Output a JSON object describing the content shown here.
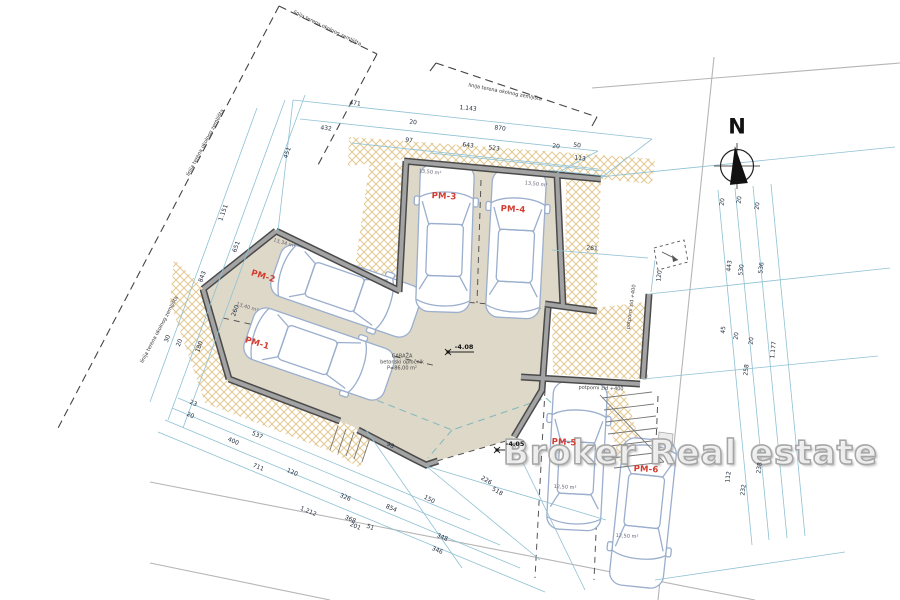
{
  "compass": {
    "label": "N"
  },
  "watermark": {
    "text": "Broker Real estate"
  },
  "colors": {
    "dimension_line": "#8fc1d4",
    "hatch": "#d8b56b",
    "floor": "#ded8c8",
    "wall": "#4a4a4a",
    "parking_label": "#d43c31",
    "watermark_gray": "#a6a6a6"
  },
  "parking_spots": [
    {
      "id": "PM-1",
      "area": "13,40 m²"
    },
    {
      "id": "PM-2",
      "area": "13,34 m²"
    },
    {
      "id": "PM-3",
      "area": "13,50 m²"
    },
    {
      "id": "PM-4",
      "area": "13,50 m²"
    },
    {
      "id": "PM-5",
      "area": "12,50 m²"
    },
    {
      "id": "PM-6",
      "area": "12,50 m²"
    }
  ],
  "garage_note": [
    "GARAŽA",
    "betonski opločnik",
    "P=86,00 m²"
  ],
  "elevation_markers": [
    "-4.08",
    "-4.05"
  ],
  "boundary_label": "linija terena okolnog zemljišta",
  "retaining_wall_label": "potporni zid +400",
  "annotations": [
    {
      "t": "471",
      "x": 355,
      "y": 104,
      "r": 6,
      "c": "dim"
    },
    {
      "t": "1.143",
      "x": 468,
      "y": 109,
      "r": 6,
      "c": "dim"
    },
    {
      "t": "432",
      "x": 326,
      "y": 129,
      "r": 6,
      "c": "dim"
    },
    {
      "t": "20",
      "x": 413,
      "y": 123,
      "r": 6,
      "c": "dim"
    },
    {
      "t": "870",
      "x": 500,
      "y": 129,
      "r": 6,
      "c": "dim"
    },
    {
      "t": "97",
      "x": 409,
      "y": 141,
      "r": 6,
      "c": "dim"
    },
    {
      "t": "643",
      "x": 468,
      "y": 146,
      "r": 6,
      "c": "dim"
    },
    {
      "t": "523",
      "x": 494,
      "y": 149,
      "r": 6,
      "c": "dim"
    },
    {
      "t": "20",
      "x": 556,
      "y": 147,
      "r": 6,
      "c": "dim"
    },
    {
      "t": "50",
      "x": 577,
      "y": 146,
      "r": 6,
      "c": "dim"
    },
    {
      "t": "113",
      "x": 580,
      "y": 159,
      "r": 6,
      "c": "dim"
    },
    {
      "t": "451",
      "x": 288,
      "y": 153,
      "r": -70,
      "c": "dim"
    },
    {
      "t": "1.151",
      "x": 224,
      "y": 213,
      "r": -70,
      "c": "dim"
    },
    {
      "t": "651",
      "x": 237,
      "y": 247,
      "r": -70,
      "c": "dim"
    },
    {
      "t": "843",
      "x": 203,
      "y": 277,
      "r": -70,
      "c": "dim"
    },
    {
      "t": "260",
      "x": 236,
      "y": 311,
      "r": -70,
      "c": "dim"
    },
    {
      "t": "180",
      "x": 200,
      "y": 347,
      "r": -70,
      "c": "dim"
    },
    {
      "t": "20",
      "x": 180,
      "y": 343,
      "r": -70,
      "c": "dim"
    },
    {
      "t": "30",
      "x": 168,
      "y": 339,
      "r": -70,
      "c": "dim"
    },
    {
      "t": "20",
      "x": 723,
      "y": 202,
      "r": -84,
      "c": "dim"
    },
    {
      "t": "20",
      "x": 740,
      "y": 200,
      "r": -84,
      "c": "dim"
    },
    {
      "t": "20",
      "x": 758,
      "y": 206,
      "r": -84,
      "c": "dim"
    },
    {
      "t": "443",
      "x": 730,
      "y": 266,
      "r": -84,
      "c": "dim"
    },
    {
      "t": "530",
      "x": 742,
      "y": 270,
      "r": -84,
      "c": "dim"
    },
    {
      "t": "536",
      "x": 762,
      "y": 268,
      "r": -84,
      "c": "dim"
    },
    {
      "t": "45",
      "x": 724,
      "y": 330,
      "r": -84,
      "c": "dim"
    },
    {
      "t": "20",
      "x": 737,
      "y": 336,
      "r": -84,
      "c": "dim"
    },
    {
      "t": "20",
      "x": 752,
      "y": 341,
      "r": -84,
      "c": "dim"
    },
    {
      "t": "258",
      "x": 747,
      "y": 370,
      "r": -84,
      "c": "dim"
    },
    {
      "t": "1.177",
      "x": 774,
      "y": 350,
      "r": -84,
      "c": "dim"
    },
    {
      "t": "112",
      "x": 729,
      "y": 477,
      "r": -84,
      "c": "dim"
    },
    {
      "t": "238",
      "x": 760,
      "y": 468,
      "r": -84,
      "c": "dim"
    },
    {
      "t": "232",
      "x": 744,
      "y": 490,
      "r": -84,
      "c": "dim"
    },
    {
      "t": "23",
      "x": 193,
      "y": 404,
      "r": 23,
      "c": "dim"
    },
    {
      "t": "20",
      "x": 190,
      "y": 416,
      "r": 23,
      "c": "dim"
    },
    {
      "t": "537",
      "x": 257,
      "y": 436,
      "r": 23,
      "c": "dim"
    },
    {
      "t": "400",
      "x": 233,
      "y": 442,
      "r": 23,
      "c": "dim"
    },
    {
      "t": "711",
      "x": 258,
      "y": 468,
      "r": 23,
      "c": "dim"
    },
    {
      "t": "120",
      "x": 292,
      "y": 473,
      "r": 23,
      "c": "dim"
    },
    {
      "t": "326",
      "x": 345,
      "y": 498,
      "r": 23,
      "c": "dim"
    },
    {
      "t": "1.212",
      "x": 308,
      "y": 512,
      "r": 23,
      "c": "dim"
    },
    {
      "t": "368",
      "x": 350,
      "y": 520,
      "r": 23,
      "c": "dim"
    },
    {
      "t": "201",
      "x": 355,
      "y": 527,
      "r": 23,
      "c": "dim"
    },
    {
      "t": "51",
      "x": 370,
      "y": 528,
      "r": 23,
      "c": "dim"
    },
    {
      "t": "854",
      "x": 391,
      "y": 509,
      "r": 23,
      "c": "dim"
    },
    {
      "t": "348",
      "x": 442,
      "y": 538,
      "r": 23,
      "c": "dim"
    },
    {
      "t": "346",
      "x": 437,
      "y": 551,
      "r": 23,
      "c": "dim"
    },
    {
      "t": "98",
      "x": 390,
      "y": 446,
      "r": 25,
      "c": "dim"
    },
    {
      "t": "150",
      "x": 429,
      "y": 500,
      "r": 27,
      "c": "dim"
    },
    {
      "t": "226",
      "x": 486,
      "y": 481,
      "r": 30,
      "c": "dim"
    },
    {
      "t": "518",
      "x": 497,
      "y": 492,
      "r": 30,
      "c": "dim"
    },
    {
      "t": "261",
      "x": 592,
      "y": 249,
      "r": 4,
      "c": "dim"
    },
    {
      "t": "120",
      "x": 660,
      "y": 276,
      "r": -84,
      "c": "dim"
    },
    {
      "t": "linija terena okolnog zemljišta",
      "x": 327,
      "y": 29,
      "r": 26,
      "c": "bnd"
    },
    {
      "t": "linija terena okolnog zemljišta",
      "x": 505,
      "y": 93,
      "r": 11,
      "c": "bnd"
    },
    {
      "t": "linija terena okolnog zemljišta",
      "x": 206,
      "y": 143,
      "r": -62,
      "c": "bnd"
    },
    {
      "t": "linija terena okolnog zemljišta",
      "x": 160,
      "y": 330,
      "r": -62,
      "c": "bnd"
    },
    {
      "t": "potporni zid +400",
      "x": 632,
      "y": 307,
      "r": -82,
      "c": "note"
    },
    {
      "t": "potporni zid +400",
      "x": 601,
      "y": 389,
      "r": 2,
      "c": "note"
    },
    {
      "t": "GARAŽA",
      "x": 402,
      "y": 357,
      "r": 0,
      "c": "note"
    },
    {
      "t": "betonski opločnik",
      "x": 402,
      "y": 363,
      "r": 0,
      "c": "note"
    },
    {
      "t": "P=86,00 m²",
      "x": 402,
      "y": 369,
      "r": 0,
      "c": "note"
    },
    {
      "t": "-4.08",
      "x": 464,
      "y": 347,
      "r": 0,
      "c": "elev"
    },
    {
      "t": "-4.05",
      "x": 515,
      "y": 444,
      "r": 0,
      "c": "elev"
    },
    {
      "t": "13,50 m²",
      "x": 430,
      "y": 173,
      "r": 6,
      "c": "area"
    },
    {
      "t": "13,50 m²",
      "x": 536,
      "y": 185,
      "r": 6,
      "c": "area"
    },
    {
      "t": "13,34 m²",
      "x": 284,
      "y": 244,
      "r": 17,
      "c": "area"
    },
    {
      "t": "13,40 m²",
      "x": 247,
      "y": 308,
      "r": 17,
      "c": "area"
    },
    {
      "t": "12,50 m²",
      "x": 565,
      "y": 488,
      "r": 3,
      "c": "area"
    },
    {
      "t": "12,50 m²",
      "x": 627,
      "y": 537,
      "r": 3,
      "c": "area"
    },
    {
      "t": "PM-1",
      "x": 257,
      "y": 344,
      "r": 17,
      "c": "pm"
    },
    {
      "t": "PM-2",
      "x": 263,
      "y": 277,
      "r": 17,
      "c": "pm"
    },
    {
      "t": "PM-3",
      "x": 444,
      "y": 197,
      "r": 3,
      "c": "pm"
    },
    {
      "t": "PM-4",
      "x": 513,
      "y": 210,
      "r": 3,
      "c": "pm"
    },
    {
      "t": "PM-5",
      "x": 564,
      "y": 443,
      "r": 3,
      "c": "pm"
    },
    {
      "t": "PM-6",
      "x": 646,
      "y": 470,
      "r": 3,
      "c": "pm"
    }
  ]
}
